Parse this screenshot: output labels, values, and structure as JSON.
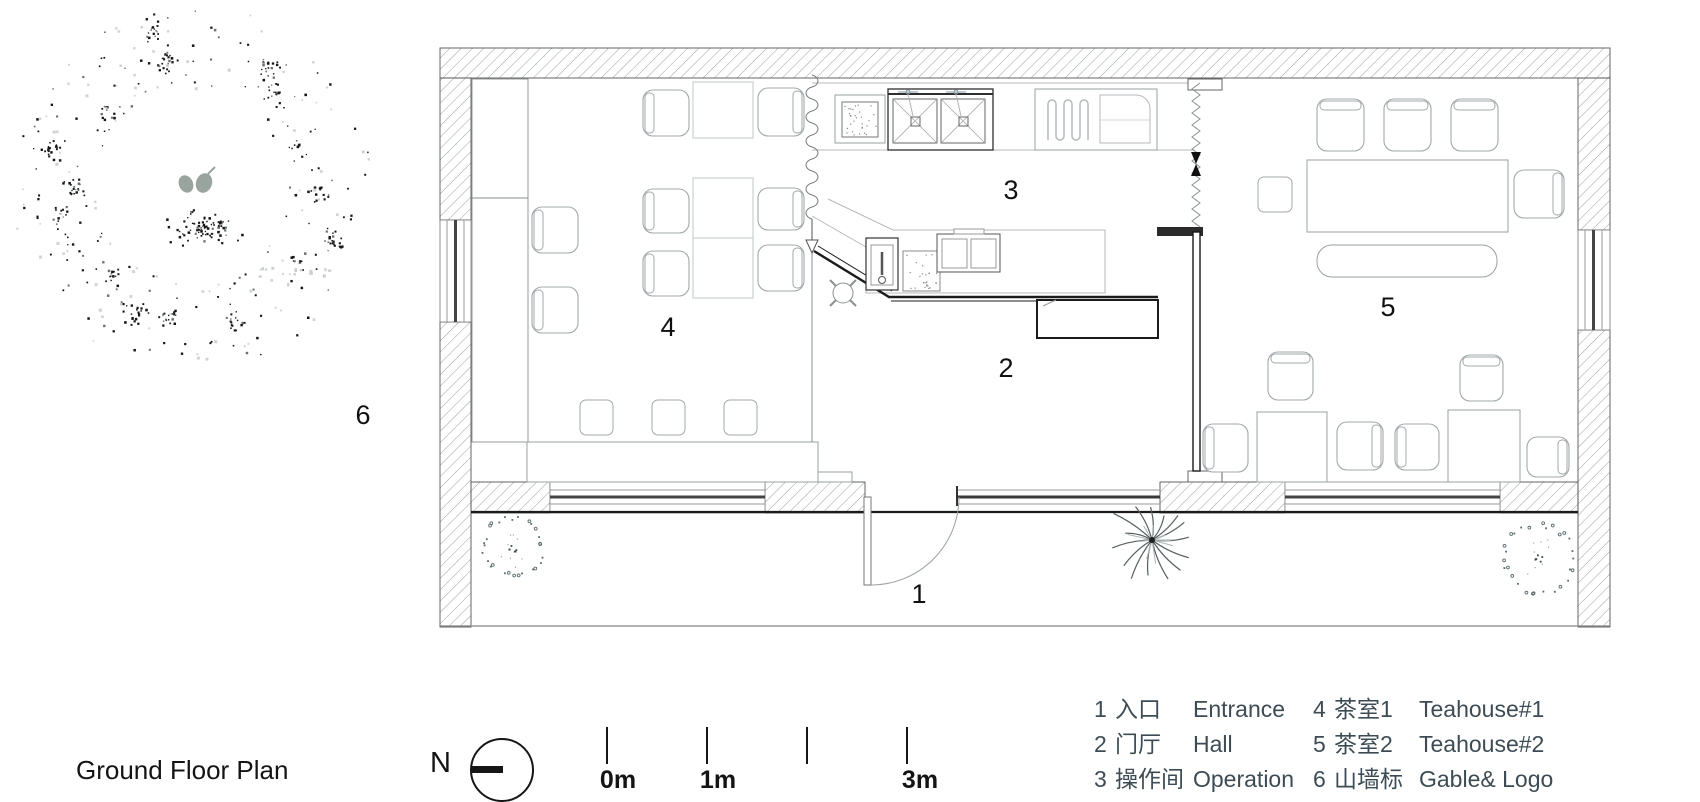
{
  "title": "Ground Floor Plan",
  "north_label": "N",
  "scale_bar": {
    "labels": [
      "0m",
      "1m",
      "3m"
    ]
  },
  "plan": {
    "room_labels": [
      "1",
      "2",
      "3",
      "4",
      "5",
      "6"
    ]
  },
  "legend": {
    "entries": [
      {
        "num": "1",
        "zh": "入口",
        "en": "Entrance"
      },
      {
        "num": "2",
        "zh": "门厅",
        "en": "Hall"
      },
      {
        "num": "3",
        "zh": "操作间",
        "en": "Operation"
      },
      {
        "num": "4",
        "zh": "茶室1",
        "en": "Teahouse#1"
      },
      {
        "num": "5",
        "zh": "茶室2",
        "en": "Teahouse#2"
      },
      {
        "num": "6",
        "zh": "山墙标识",
        "en": "Gable& Logo"
      }
    ]
  },
  "colors": {
    "text": "#3d4c54",
    "line_dark": "#1b1b1b",
    "wall_stroke": "#555555",
    "hatch": "#9aa1a3",
    "furniture": "#a2a8ab",
    "furniture_light": "#c2c7c9",
    "counter": "#b4b9bb",
    "glazing": "#999999",
    "leaf": "#9aa49e"
  }
}
